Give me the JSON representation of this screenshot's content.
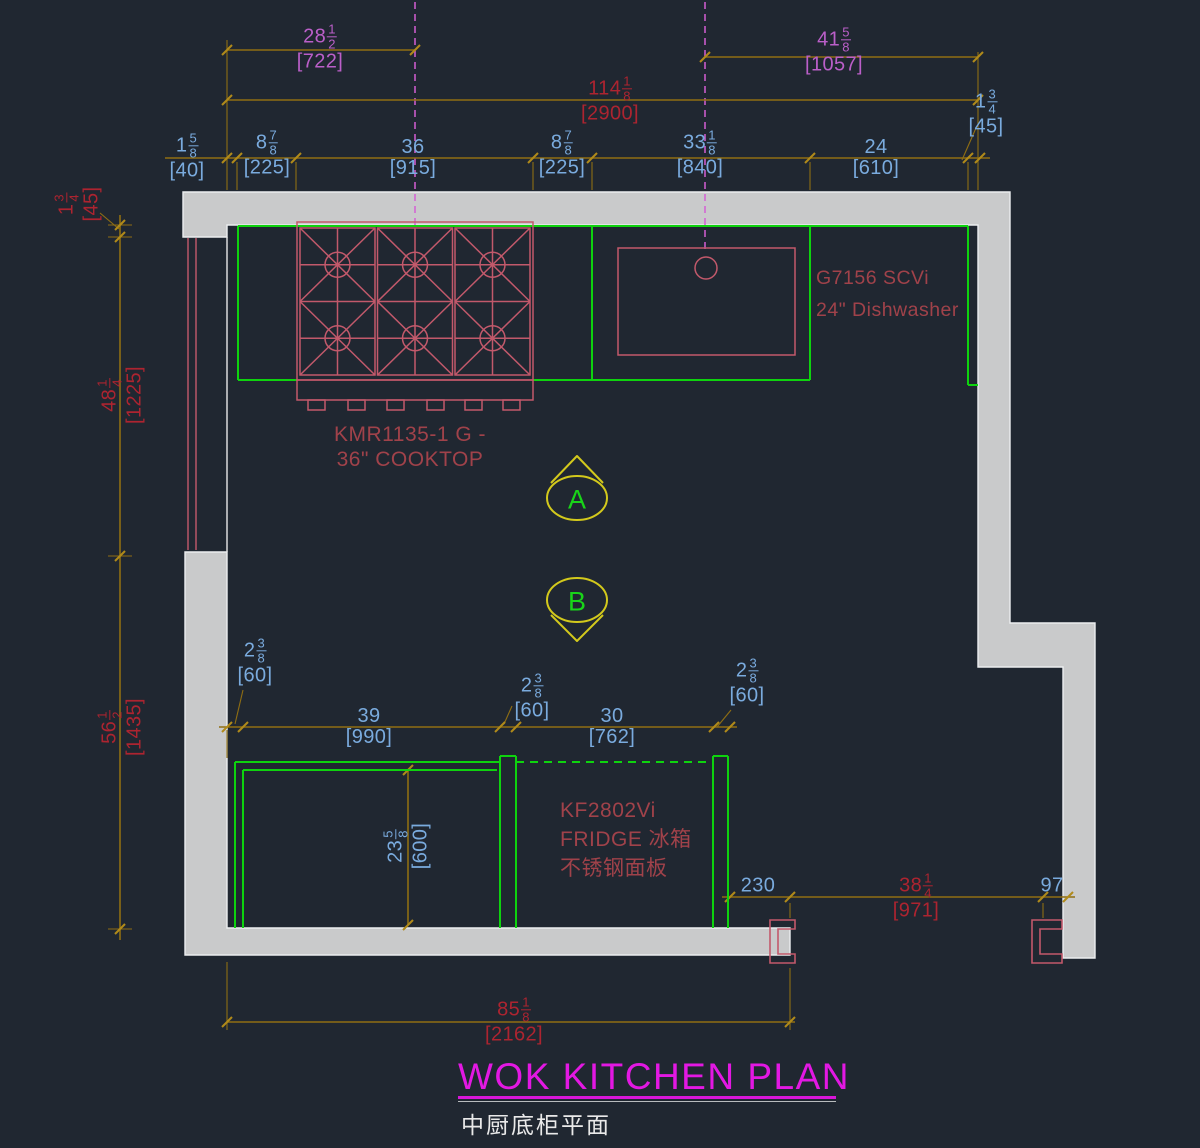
{
  "colors": {
    "background": "#202731",
    "wall_fill": "#c9cacb",
    "wall_outline": "#eceef0",
    "cabinet_green": "#0ed30e",
    "fixture_pink": "#c2596b",
    "dim_line_olive": "#8f6e13",
    "dim_text_blue": "#7aabde",
    "dim_text_red": "#ad2430",
    "dim_text_violet": "#bb5fc9",
    "centerline_magenta": "#d45fd4",
    "title_magenta": "#e318e3",
    "fixture_label_red": "#a0424a",
    "marker_yellow": "#d3c91c",
    "marker_letter_green": "#19d419"
  },
  "title": {
    "main": "WOK KITCHEN PLAN",
    "sub": "中厨底柜平面"
  },
  "markers": {
    "a": "A",
    "b": "B"
  },
  "labels": {
    "cooktop_line1": "KMR1135-1 G -",
    "cooktop_line2": "36\" COOKTOP",
    "dishwasher_line1": "G7156 SCVi",
    "dishwasher_line2": "24\" Dishwasher",
    "fridge_line1": "KF2802Vi",
    "fridge_line2": "FRIDGE 冰箱",
    "fridge_line3": "不锈钢面板"
  },
  "dims": {
    "d722": {
      "whole": "28",
      "num": "1",
      "den": "2",
      "mm": "[722]"
    },
    "d1057": {
      "whole": "41",
      "num": "5",
      "den": "8",
      "mm": "[1057]"
    },
    "d2900": {
      "whole": "114",
      "num": "1",
      "den": "8",
      "mm": "[2900]"
    },
    "d40": {
      "whole": "1",
      "num": "5",
      "den": "8",
      "mm": "[40]"
    },
    "d225a": {
      "whole": "8",
      "num": "7",
      "den": "8",
      "mm": "[225]"
    },
    "d915": {
      "whole": "36",
      "mm": "[915]"
    },
    "d225b": {
      "whole": "8",
      "num": "7",
      "den": "8",
      "mm": "[225]"
    },
    "d840": {
      "whole": "33",
      "num": "1",
      "den": "8",
      "mm": "[840]"
    },
    "d610": {
      "whole": "24",
      "mm": "[610]"
    },
    "d45_top": {
      "whole": "1",
      "num": "3",
      "den": "4",
      "mm": "[45]"
    },
    "d45_left": {
      "whole": "1",
      "num": "3",
      "den": "4",
      "mm": "[45]"
    },
    "d1225": {
      "whole": "48",
      "num": "1",
      "den": "4",
      "mm": "[1225]"
    },
    "d1435": {
      "whole": "56",
      "num": "1",
      "den": "2",
      "mm": "[1435]"
    },
    "d60a": {
      "whole": "2",
      "num": "3",
      "den": "8",
      "mm": "[60]"
    },
    "d990": {
      "whole": "39",
      "mm": "[990]"
    },
    "d60b": {
      "whole": "2",
      "num": "3",
      "den": "8",
      "mm": "[60]"
    },
    "d762": {
      "whole": "30",
      "mm": "[762]"
    },
    "d60c": {
      "whole": "2",
      "num": "3",
      "den": "8",
      "mm": "[60]"
    },
    "d600": {
      "whole": "23",
      "num": "5",
      "den": "8",
      "mm": "[600]"
    },
    "d230": {
      "whole": "230"
    },
    "d971": {
      "whole": "38",
      "num": "1",
      "den": "4",
      "mm": "[971]"
    },
    "d97": {
      "whole": "97"
    },
    "d2162": {
      "whole": "85",
      "num": "1",
      "den": "8",
      "mm": "[2162]"
    }
  }
}
